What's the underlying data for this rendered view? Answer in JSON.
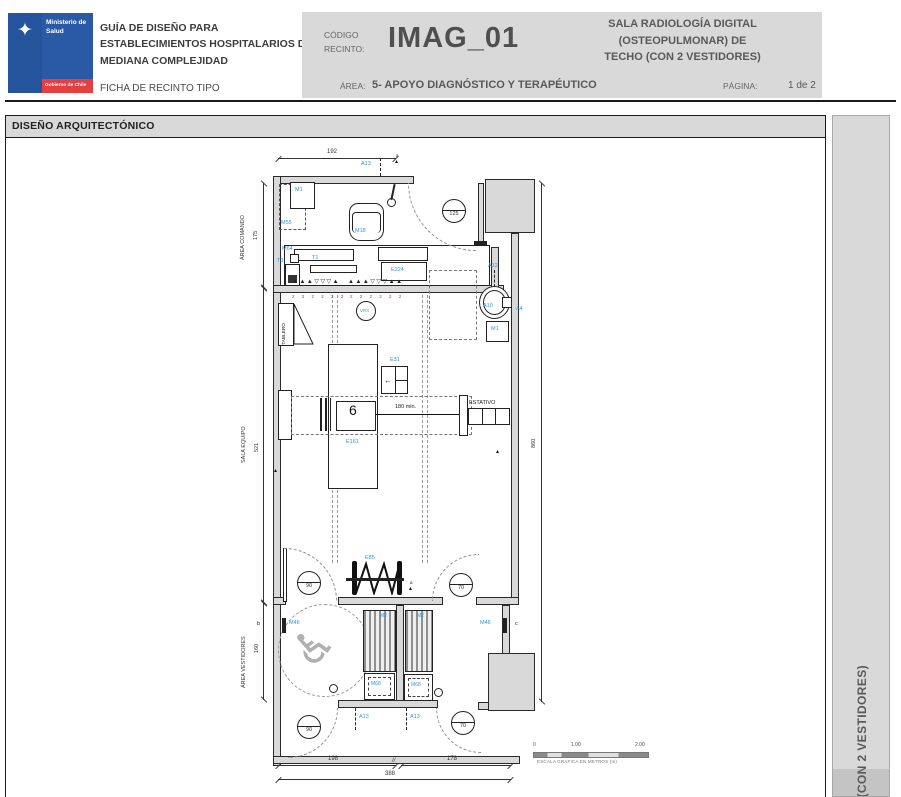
{
  "header": {
    "logo": {
      "ministry_line1": "Ministerio de",
      "ministry_line2": "Salud",
      "government": "Gobierno de Chile",
      "emblem_icon": "✦"
    },
    "guide_title": "GUÍA DE DISEÑO PARA ESTABLECIMIENTOS HOSPITALARIOS DE MEDIANA COMPLEJIDAD",
    "sheet_type": "FICHA DE RECINTO TIPO",
    "code_label_line1": "CÓDIGO",
    "code_label_line2": "RECINTO:",
    "room_code": "IMAG_01",
    "room_name_line1": "SALA RADIOLOGÍA DIGITAL",
    "room_name_line2": "(OSTEOPULMONAR) DE",
    "room_name_line3": "TECHO (CON 2 VESTIDORES)",
    "area_label": "ÁREA:",
    "area_value": "5- APOYO DIAGNÓSTICO Y TERAPÉUTICO",
    "page_label": "PÁGINA:",
    "page_value": "1 de 2"
  },
  "section": {
    "title": "DISEÑO ARQUITECTÓNICO"
  },
  "sidebar": {
    "vertical_text": "O (CON 2 VESTIDORES)"
  },
  "plan": {
    "zones": {
      "comando": "ÁREA COMANDO",
      "equipo": "SALA EQUIPO",
      "vestidores": "ÁREA VESTIDORES"
    },
    "dims": {
      "top_width": "192",
      "comando_depth": "175",
      "equipo_depth": "521",
      "vestidores_depth": "160",
      "total_height": "860",
      "bottom_left": "198",
      "bottom_right": "178",
      "bottom_total": "388",
      "clearance": "180 min.",
      "break_mark": "//"
    },
    "doors": {
      "main": "125",
      "d90": "90",
      "d70": "70"
    },
    "labels": {
      "a13": "A13",
      "m1": "M1",
      "m55": "M55",
      "m18": "M18",
      "m64": "M64",
      "t3": "T3",
      "t1": "T1",
      "e224": "E224",
      "vrx": "VRX",
      "tablero": "TABLERO",
      "e31": "E31",
      "e161": "E161",
      "estativo": "ESTATIVO",
      "a12": "A12",
      "a10": "A10",
      "a4": "A4",
      "e85": "E85",
      "m46": "M46",
      "m2": "M2",
      "m68": "M68"
    },
    "markers": {
      "a": "a",
      "b": "b",
      "c": "c"
    },
    "symbols": {
      "outlets_left": "▲▲▲▽▽▽▲",
      "outlets_right": "▲▲▲▽▽▽▲▲",
      "circuits_left": "2 2 2 2 2 2",
      "circuits_right": "2 2 2 2 2 2",
      "wheelchair_icon": "♿"
    },
    "scale_bar": {
      "zero": "0",
      "one": "1.00",
      "two": "2.00",
      "caption": "ESCALA GRAFICA EN METROS (m)"
    }
  },
  "colors": {
    "accent_blue": "#2F97D8",
    "wall_gray": "#D9D9D9",
    "header_gray": "#D9D9D9",
    "logo_blue": "#25549D",
    "logo_red": "#E63F3F",
    "text_gray": "#595959",
    "circuit_red": "#A93A2E"
  }
}
